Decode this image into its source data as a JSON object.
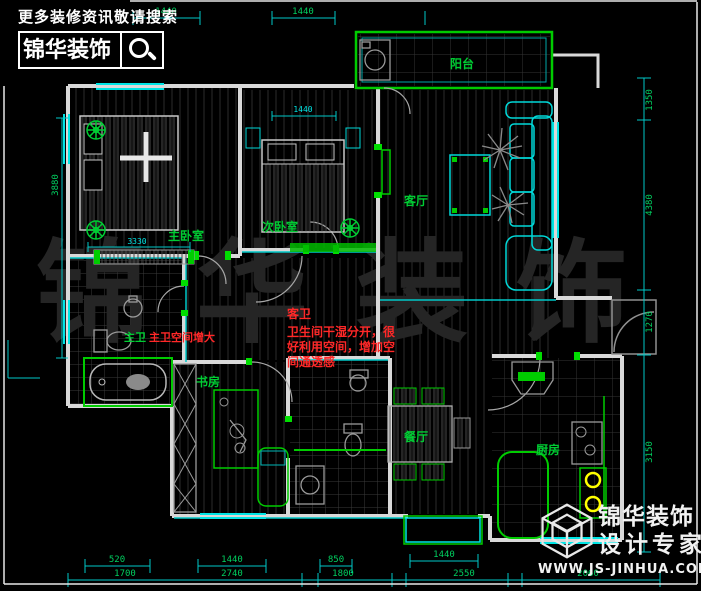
{
  "header": {
    "tagline": "更多装修资讯敬请搜索",
    "brand": "锦华装饰"
  },
  "footer_logo": {
    "brand_line1": "锦华装饰",
    "brand_line2": "设计专家",
    "website": "WWW.JS-JINHUA.COM"
  },
  "watermark": "锦华装饰",
  "rooms": {
    "master_bedroom": "主卧室",
    "second_bedroom": "次卧室",
    "living_room": "客厅",
    "balcony": "阳台",
    "study": "书房",
    "dining_room": "餐厅",
    "kitchen": "厨房",
    "master_bath": "主卫"
  },
  "annotations": {
    "guest_bath_title": "客卫",
    "guest_bath_line1": "卫生间干湿分开，很",
    "guest_bath_line2": "好利用空间，增加空",
    "guest_bath_line3": "间通透感",
    "master_bath_note": "主卫空间增大"
  },
  "dimensions": {
    "top": [
      "1440",
      "1440"
    ],
    "left": [
      "3880"
    ],
    "right": [
      "1350",
      "4380",
      "1270",
      "3150"
    ],
    "bottom_inner": [
      "520",
      "1440",
      "850",
      "1440"
    ],
    "bottom_outer": [
      "1700",
      "2740",
      "1800",
      "2550",
      "2060"
    ],
    "inner": {
      "master_width": "3330",
      "second_top": "1440"
    }
  },
  "colors": {
    "background": "#000000",
    "wall": "#d9d9d9",
    "accent_green": "#00cc33",
    "accent_cyan": "#00c8c8",
    "annotation_red": "#ff2828",
    "dim_text_green": "#00d060",
    "stove_yellow": "#ffff00",
    "watermark_gray": "#252525"
  }
}
